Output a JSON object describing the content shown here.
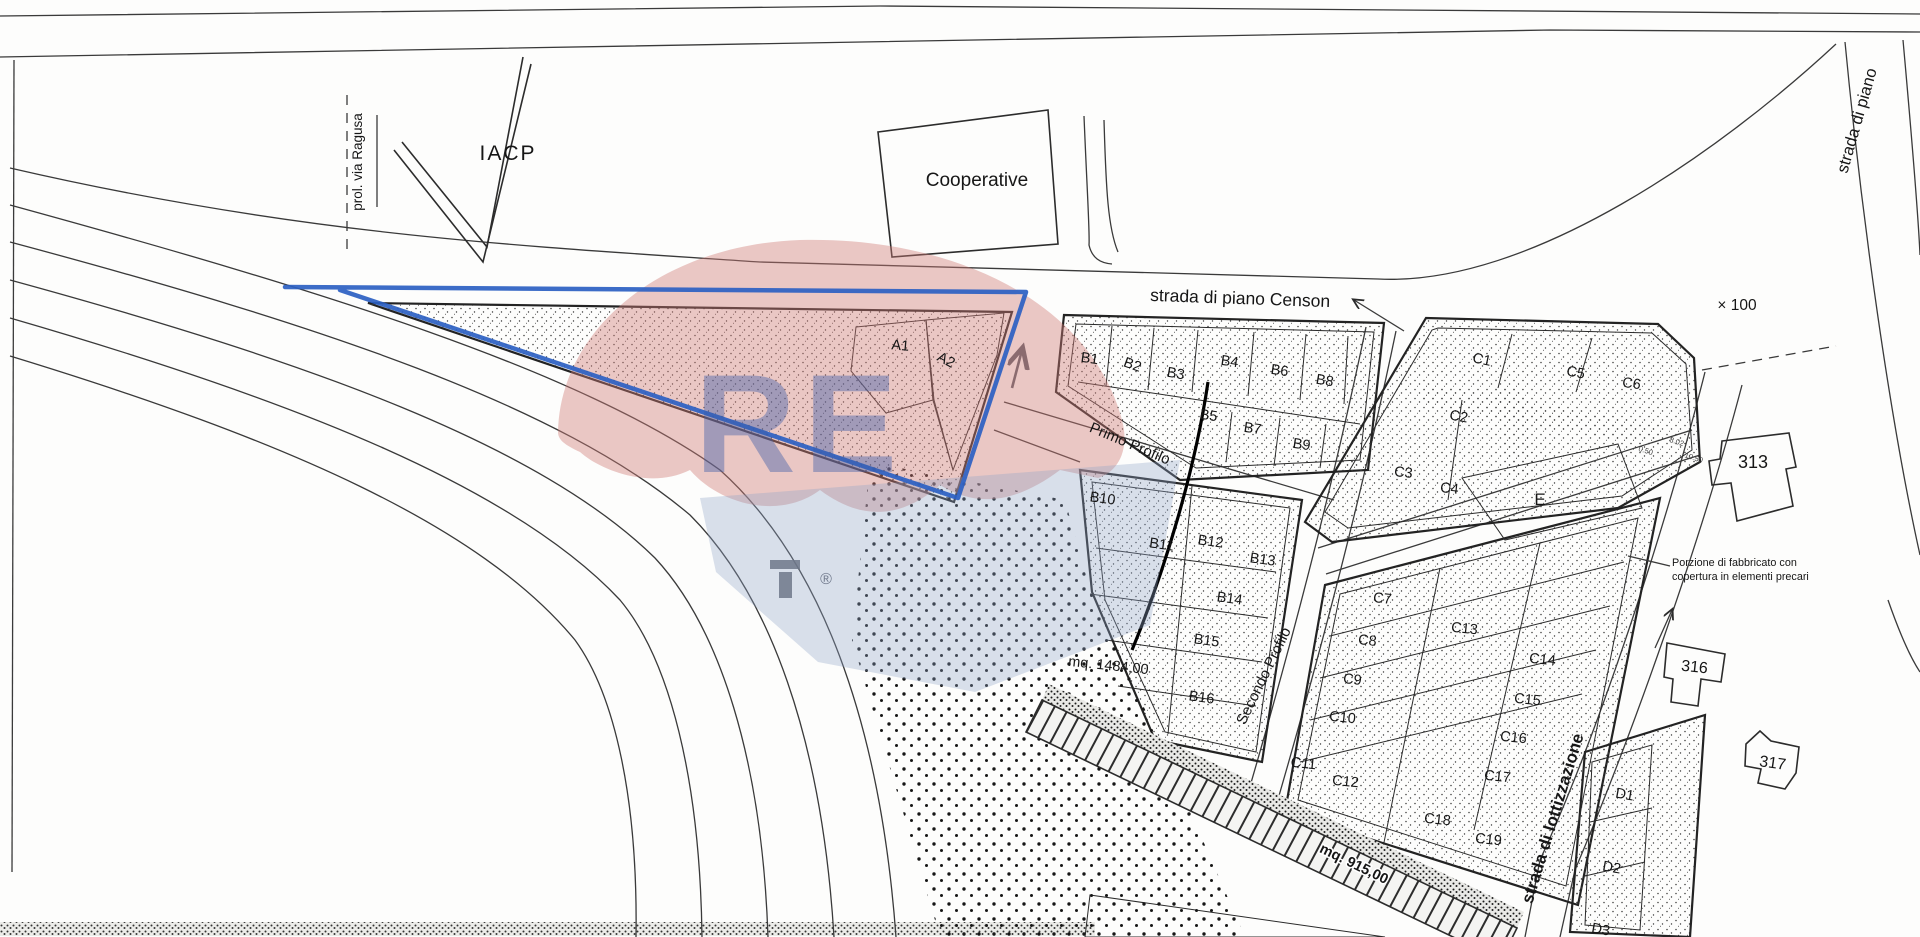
{
  "plan_meta": {
    "kind": "lottizzazione-site-plan",
    "highlight_color": "#2b5fc2",
    "paper_color": "#fdfdfc",
    "line_color": "#2e2e2e"
  },
  "watermark": {
    "brand_letters": "RE",
    "registered_mark": "®",
    "balloon_top_color": "rgba(207,123,119,0.42)",
    "balloon_bottom_color": "rgba(143,163,200,0.34)",
    "letters_color": "rgba(60,92,168,0.42)"
  },
  "labels": [
    {
      "id": "road-prol-via-ragusa",
      "group": "road",
      "text": "prol. via Ragusa",
      "x": 362,
      "y": 162,
      "rot": -90,
      "size": 13.5
    },
    {
      "id": "building-iacp",
      "group": "building",
      "text": "IACP",
      "x": 508,
      "y": 160,
      "rot": 0,
      "size": 21,
      "ls": 2
    },
    {
      "id": "building-cooperative",
      "group": "building",
      "text": "Cooperative",
      "x": 977,
      "y": 186,
      "rot": 0,
      "size": 19
    },
    {
      "id": "road-strada-di-piano-censon",
      "group": "road",
      "text": "strada di piano Censon",
      "x": 1240,
      "y": 304,
      "rot": 2,
      "size": 17.5
    },
    {
      "id": "road-strada-di-piano",
      "group": "road",
      "text": "strada di piano",
      "x": 1862,
      "y": 122,
      "rot": -74,
      "size": 16.5
    },
    {
      "id": "scale-mark",
      "group": "annotation",
      "text": "× 100",
      "x": 1737,
      "y": 310,
      "rot": 0,
      "size": 15.5
    },
    {
      "id": "profile-primo",
      "group": "profile",
      "text": "Primo Profilo",
      "x": 1128,
      "y": 448,
      "rot": 23,
      "size": 15
    },
    {
      "id": "profile-secondo",
      "group": "profile",
      "text": "Secondo Profilo",
      "x": 1268,
      "y": 678,
      "rot": -64,
      "size": 15
    },
    {
      "id": "road-strada-di-lottizzazione",
      "group": "road",
      "text": "strada di lottizzazione",
      "x": 1558,
      "y": 820,
      "rot": -73,
      "size": 17,
      "weight": 700
    },
    {
      "id": "area-mq-1484",
      "group": "area",
      "text": "mq. 1484,00",
      "x": 1108,
      "y": 670,
      "rot": 6,
      "size": 14.5
    },
    {
      "id": "area-mq-915",
      "group": "area",
      "text": "mq. 915,00",
      "x": 1352,
      "y": 868,
      "rot": 26,
      "size": 14.5,
      "weight": 700,
      "halo": true
    },
    {
      "id": "note-porzione-line1",
      "group": "annotation",
      "text": "Porzione di fabbricato con",
      "x": 1672,
      "y": 566,
      "rot": 0,
      "size": 10.8,
      "anchor": "start"
    },
    {
      "id": "note-porzione-line2",
      "group": "annotation",
      "text": "copertura in elementi precari",
      "x": 1672,
      "y": 580,
      "rot": 0,
      "size": 10.8,
      "anchor": "start"
    },
    {
      "id": "building-313",
      "group": "building",
      "text": "313",
      "x": 1753,
      "y": 468,
      "rot": 0,
      "size": 18
    },
    {
      "id": "building-316",
      "group": "building",
      "text": "316",
      "x": 1694,
      "y": 672,
      "rot": 6,
      "size": 16
    },
    {
      "id": "building-317",
      "group": "building",
      "text": "317",
      "x": 1772,
      "y": 768,
      "rot": 8,
      "size": 16
    },
    {
      "id": "dim-0-50",
      "group": "dimension",
      "text": "0.50",
      "x": 1645,
      "y": 453,
      "rot": 18,
      "size": 7.5,
      "color": "#444444"
    },
    {
      "id": "dim-8-02",
      "group": "dimension",
      "text": "8.02",
      "x": 1676,
      "y": 444,
      "rot": 18,
      "size": 7.5,
      "color": "#444444"
    },
    {
      "id": "dim-10-50",
      "group": "dimension",
      "text": "10.50",
      "x": 1693,
      "y": 460,
      "rot": 18,
      "size": 7.5,
      "color": "#444444"
    },
    {
      "id": "watermark-letters",
      "group": "watermark",
      "text": "RE",
      "x": 800,
      "y": 472,
      "rot": 0,
      "size": 140,
      "weight": 700,
      "color": "rgba(60,92,168,0.42)",
      "ls": 8
    },
    {
      "id": "watermark-registered",
      "group": "watermark",
      "text": "®",
      "x": 826,
      "y": 584,
      "rot": 0,
      "size": 16,
      "color": "rgba(95,105,125,0.85)"
    },
    {
      "id": "lot-a1",
      "group": "lot",
      "text": "A1",
      "x": 900,
      "y": 350,
      "rot": 5,
      "size": 14.5
    },
    {
      "id": "lot-a2",
      "group": "lot",
      "text": "A2",
      "x": 944,
      "y": 364,
      "rot": 28,
      "size": 14.5
    },
    {
      "id": "lot-b1",
      "group": "lot",
      "text": "B1",
      "x": 1089,
      "y": 363,
      "rot": 8,
      "size": 14.5
    },
    {
      "id": "lot-b2",
      "group": "lot",
      "text": "B2",
      "x": 1131,
      "y": 369,
      "rot": 20,
      "size": 14.5
    },
    {
      "id": "lot-b3",
      "group": "lot",
      "text": "B3",
      "x": 1175,
      "y": 378,
      "rot": 10,
      "size": 14.5
    },
    {
      "id": "lot-b4",
      "group": "lot",
      "text": "B4",
      "x": 1229,
      "y": 366,
      "rot": 8,
      "size": 14.5
    },
    {
      "id": "lot-b6",
      "group": "lot",
      "text": "B6",
      "x": 1279,
      "y": 375,
      "rot": 8,
      "size": 14.5
    },
    {
      "id": "lot-b8",
      "group": "lot",
      "text": "B8",
      "x": 1324,
      "y": 385,
      "rot": 10,
      "size": 14.5
    },
    {
      "id": "lot-b5",
      "group": "lot",
      "text": "B5",
      "x": 1208,
      "y": 420,
      "rot": 8,
      "size": 14.5
    },
    {
      "id": "lot-b7",
      "group": "lot",
      "text": "B7",
      "x": 1252,
      "y": 433,
      "rot": 8,
      "size": 14.5
    },
    {
      "id": "lot-b9",
      "group": "lot",
      "text": "B9",
      "x": 1301,
      "y": 449,
      "rot": 8,
      "size": 14.5
    },
    {
      "id": "lot-b10",
      "group": "lot",
      "text": "B10",
      "x": 1102,
      "y": 503,
      "rot": 8,
      "size": 14.5
    },
    {
      "id": "lot-b11",
      "group": "lot",
      "text": "B11",
      "x": 1161,
      "y": 549,
      "rot": 8,
      "size": 14.5
    },
    {
      "id": "lot-b12",
      "group": "lot",
      "text": "B12",
      "x": 1210,
      "y": 546,
      "rot": 8,
      "size": 14.5
    },
    {
      "id": "lot-b13",
      "group": "lot",
      "text": "B13",
      "x": 1262,
      "y": 564,
      "rot": 8,
      "size": 14.5
    },
    {
      "id": "lot-b14",
      "group": "lot",
      "text": "B14",
      "x": 1229,
      "y": 603,
      "rot": 8,
      "size": 14.5
    },
    {
      "id": "lot-b15",
      "group": "lot",
      "text": "B15",
      "x": 1206,
      "y": 645,
      "rot": 8,
      "size": 14.5
    },
    {
      "id": "lot-b16",
      "group": "lot",
      "text": "B16",
      "x": 1201,
      "y": 702,
      "rot": 8,
      "size": 14.5
    },
    {
      "id": "lot-c1",
      "group": "lot",
      "text": "C1",
      "x": 1481,
      "y": 364,
      "rot": 12,
      "size": 14.5
    },
    {
      "id": "lot-c5",
      "group": "lot",
      "text": "C5",
      "x": 1575,
      "y": 377,
      "rot": 10,
      "size": 14.5
    },
    {
      "id": "lot-c6",
      "group": "lot",
      "text": "C6",
      "x": 1631,
      "y": 388,
      "rot": 8,
      "size": 14.5
    },
    {
      "id": "lot-c2",
      "group": "lot",
      "text": "C2",
      "x": 1458,
      "y": 421,
      "rot": 10,
      "size": 14.5
    },
    {
      "id": "lot-c3",
      "group": "lot",
      "text": "C3",
      "x": 1403,
      "y": 477,
      "rot": 6,
      "size": 14.5
    },
    {
      "id": "lot-c4",
      "group": "lot",
      "text": "C4",
      "x": 1449,
      "y": 493,
      "rot": 6,
      "size": 14.5
    },
    {
      "id": "lot-e",
      "group": "lot",
      "text": "E",
      "x": 1540,
      "y": 505,
      "rot": 0,
      "size": 17
    },
    {
      "id": "lot-c7",
      "group": "lot",
      "text": "C7",
      "x": 1382,
      "y": 603,
      "rot": 6,
      "size": 14.5
    },
    {
      "id": "lot-c13",
      "group": "lot",
      "text": "C13",
      "x": 1464,
      "y": 633,
      "rot": 6,
      "size": 14.5
    },
    {
      "id": "lot-c8",
      "group": "lot",
      "text": "C8",
      "x": 1367,
      "y": 645,
      "rot": 6,
      "size": 14.5
    },
    {
      "id": "lot-c14",
      "group": "lot",
      "text": "C14",
      "x": 1542,
      "y": 664,
      "rot": 6,
      "size": 14.5
    },
    {
      "id": "lot-c9",
      "group": "lot",
      "text": "C9",
      "x": 1352,
      "y": 684,
      "rot": 6,
      "size": 14.5
    },
    {
      "id": "lot-c15",
      "group": "lot",
      "text": "C15",
      "x": 1527,
      "y": 704,
      "rot": 6,
      "size": 14.5
    },
    {
      "id": "lot-c10",
      "group": "lot",
      "text": "C10",
      "x": 1342,
      "y": 722,
      "rot": 6,
      "size": 14.5
    },
    {
      "id": "lot-c16",
      "group": "lot",
      "text": "C16",
      "x": 1513,
      "y": 742,
      "rot": 6,
      "size": 14.5
    },
    {
      "id": "lot-c11",
      "group": "lot",
      "text": "C11",
      "x": 1303,
      "y": 768,
      "rot": 6,
      "size": 14.5
    },
    {
      "id": "lot-c12",
      "group": "lot",
      "text": "C12",
      "x": 1345,
      "y": 786,
      "rot": 6,
      "size": 14.5
    },
    {
      "id": "lot-c17",
      "group": "lot",
      "text": "C17",
      "x": 1497,
      "y": 781,
      "rot": 6,
      "size": 14.5
    },
    {
      "id": "lot-c18",
      "group": "lot",
      "text": "C18",
      "x": 1437,
      "y": 824,
      "rot": 6,
      "size": 14.5
    },
    {
      "id": "lot-c19",
      "group": "lot",
      "text": "C19",
      "x": 1488,
      "y": 844,
      "rot": 6,
      "size": 14.5
    },
    {
      "id": "lot-d1",
      "group": "lot",
      "text": "D1",
      "x": 1624,
      "y": 799,
      "rot": 10,
      "size": 14.5
    },
    {
      "id": "lot-d2",
      "group": "lot",
      "text": "D2",
      "x": 1611,
      "y": 872,
      "rot": 10,
      "size": 14.5
    },
    {
      "id": "lot-d3",
      "group": "lot",
      "text": "D3",
      "x": 1600,
      "y": 934,
      "rot": 10,
      "size": 14.5
    }
  ]
}
